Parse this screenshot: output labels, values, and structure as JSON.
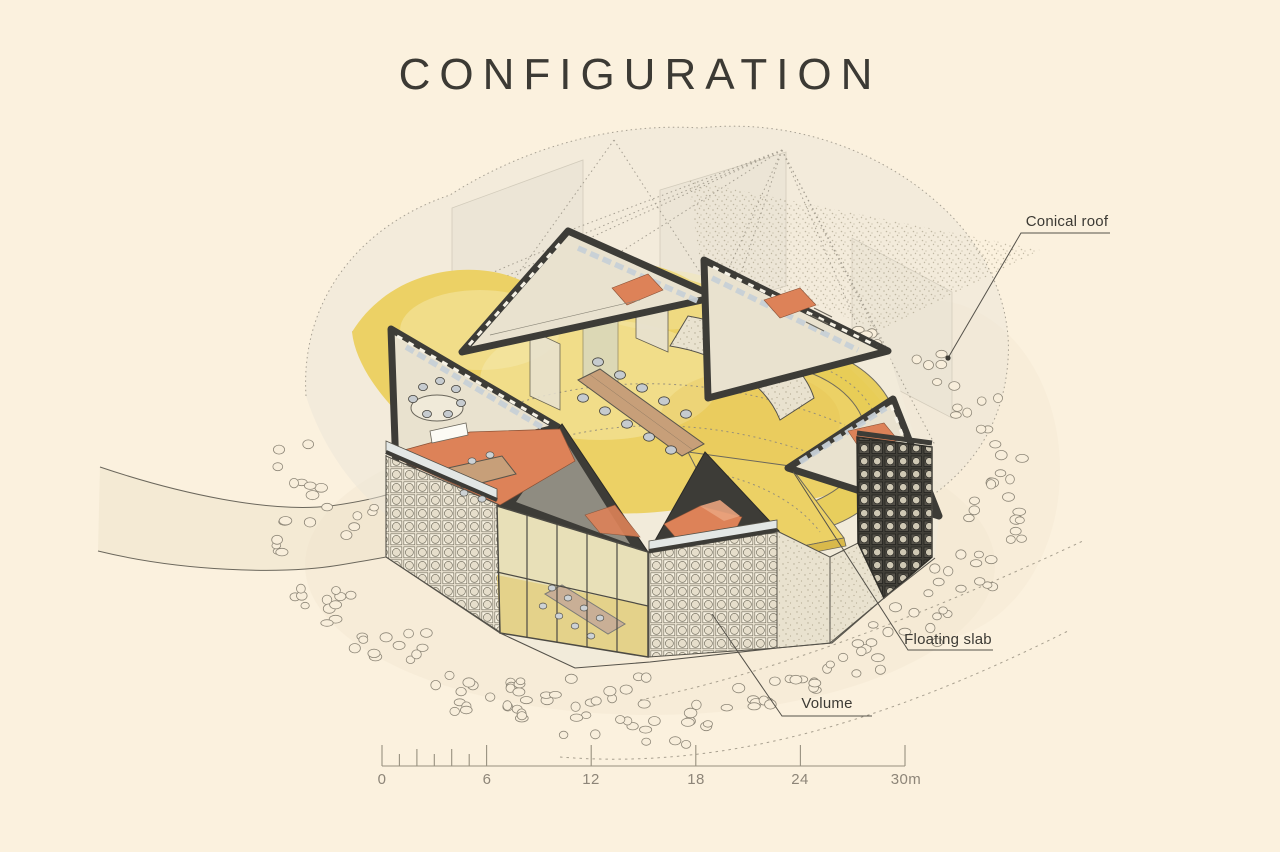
{
  "title": "CONFIGURATION",
  "annotations": {
    "conical_roof": "Conical roof",
    "floating_slab": "Floating slab",
    "volume": "Volume"
  },
  "scale_bar": {
    "labels": [
      "0",
      "6",
      "12",
      "18",
      "24",
      "30m"
    ]
  },
  "colors": {
    "background": "#fbf1de",
    "ink": "#3c3a34",
    "scale_ink": "#8d8578",
    "line": "#55524a",
    "floor_yellow": "#ecd165",
    "floor_yellow_light": "#f6e9ad",
    "ramp_yellow": "#e8cd57",
    "salmon": "#dd8258",
    "section_dark": "#3d3c37",
    "glass": "#ccd4d9",
    "concrete": "#e9e2cf",
    "tan": "#c79f79",
    "pebble": "#8e8778",
    "ghost": "#ebe6d7",
    "ghost_line": "#9d978a"
  }
}
